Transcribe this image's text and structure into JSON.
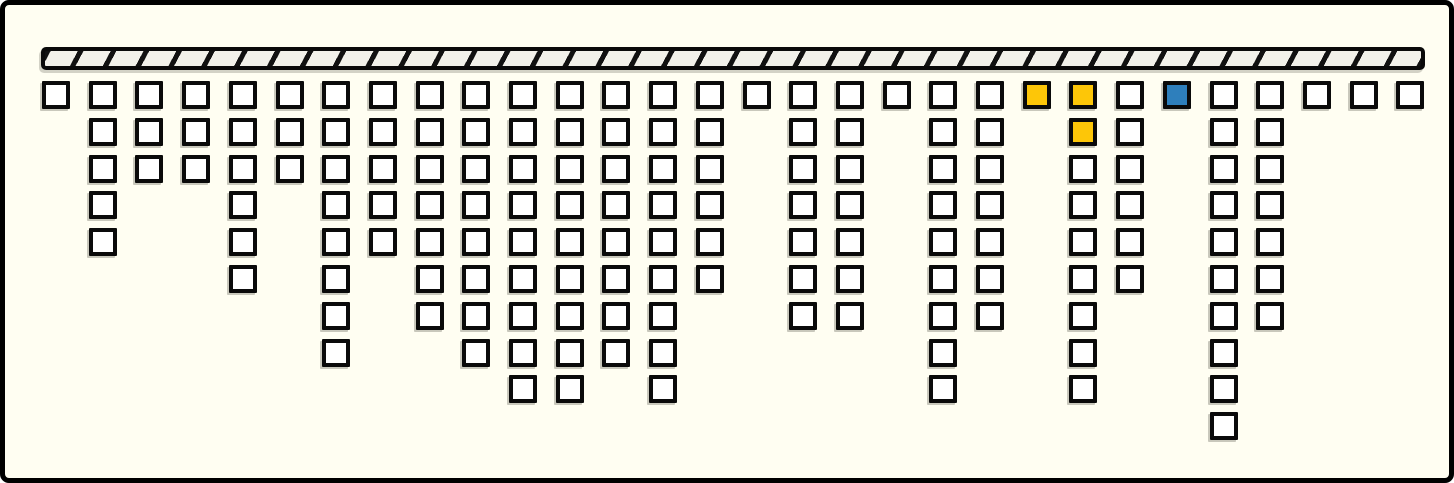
{
  "canvas": {
    "width": 1454,
    "height": 483,
    "background": "#FFFEF2",
    "frame_border_color": "#000000"
  },
  "bar": {
    "x": 36,
    "y": 42,
    "width": 1384,
    "height": 23,
    "fill": "#F2F1EA",
    "stripe_color": "#111111",
    "stripe_angle_deg": 118,
    "stripe_width": 5,
    "stripe_period": 29
  },
  "grid": {
    "origin_x": 37,
    "origin_y": 76,
    "col_pitch": 46.7,
    "row_pitch": 36.8,
    "cell_size": 28,
    "cell_fill": "#FFFFFF",
    "cell_border_color": "#0a0a0a"
  },
  "colors": {
    "yellow": "#FDC608",
    "blue": "#2E7FBC"
  },
  "columns": [
    {
      "count": 1
    },
    {
      "count": 5
    },
    {
      "count": 3
    },
    {
      "count": 3
    },
    {
      "count": 6
    },
    {
      "count": 3
    },
    {
      "count": 8
    },
    {
      "count": 5
    },
    {
      "count": 7
    },
    {
      "count": 8
    },
    {
      "count": 9
    },
    {
      "count": 9
    },
    {
      "count": 8
    },
    {
      "count": 9
    },
    {
      "count": 6
    },
    {
      "count": 1
    },
    {
      "count": 7
    },
    {
      "count": 7
    },
    {
      "count": 1
    },
    {
      "count": 9
    },
    {
      "count": 7
    },
    {
      "count": 1,
      "overrides": {
        "0": "yellow"
      }
    },
    {
      "count": 9,
      "overrides": {
        "0": "yellow",
        "1": "yellow"
      }
    },
    {
      "count": 6
    },
    {
      "count": 1,
      "overrides": {
        "0": "blue"
      }
    },
    {
      "count": 10
    },
    {
      "count": 7
    },
    {
      "count": 1
    },
    {
      "count": 1
    },
    {
      "count": 1
    }
  ],
  "chart_data": {
    "type": "bar",
    "categories": [
      1,
      2,
      3,
      4,
      5,
      6,
      7,
      8,
      9,
      10,
      11,
      12,
      13,
      14,
      15,
      16,
      17,
      18,
      19,
      20,
      21,
      22,
      23,
      24,
      25,
      26,
      27,
      28,
      29,
      30
    ],
    "values": [
      1,
      5,
      3,
      3,
      6,
      3,
      8,
      5,
      7,
      8,
      9,
      9,
      8,
      9,
      6,
      1,
      7,
      7,
      1,
      9,
      7,
      1,
      9,
      6,
      1,
      10,
      7,
      1,
      1,
      1
    ],
    "title": "",
    "xlabel": "",
    "ylabel": "",
    "ylim": [
      0,
      10
    ],
    "grid": false,
    "legend": false,
    "total_cells": 159,
    "highlighted_cells": [
      {
        "column": 22,
        "row": 1,
        "color": "yellow"
      },
      {
        "column": 23,
        "row": 1,
        "color": "yellow"
      },
      {
        "column": 23,
        "row": 2,
        "color": "yellow"
      },
      {
        "column": 25,
        "row": 1,
        "color": "blue"
      }
    ]
  }
}
